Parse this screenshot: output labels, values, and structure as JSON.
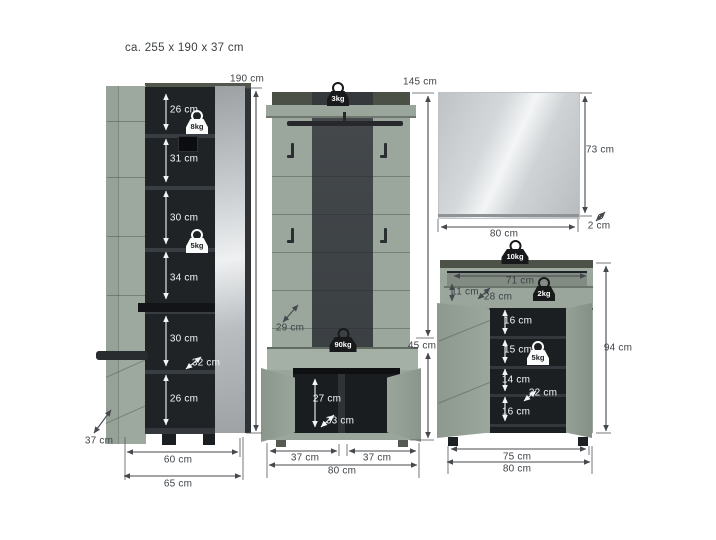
{
  "title": "ca. 255 x 190 x 37 cm",
  "colors": {
    "green": "#9BA79D",
    "interior_dark": "#202326",
    "band_gray": "#44494C",
    "mirror_light": "#E9EBEC"
  },
  "wardrobe": {
    "height": "190 cm",
    "sections": [
      "26 cm",
      "31 cm",
      "30 cm",
      "34 cm",
      "30 cm",
      "26 cm"
    ],
    "inner_depth": "32 cm",
    "depth": "37 cm",
    "inner_width": "60 cm",
    "width": "65 cm",
    "weight_top": "8kg",
    "weight_mid": "5kg"
  },
  "panel": {
    "height": "145 cm",
    "bench_height": "45 cm",
    "shelf_depth": "29 cm",
    "bench_inner_height": "27 cm",
    "bench_inner_depth": "33 cm",
    "door_left": "37 cm",
    "door_right": "37 cm",
    "width": "80 cm",
    "weight_shelf": "3kg",
    "weight_bench": "90kg"
  },
  "mirror": {
    "height": "73 cm",
    "width": "80 cm",
    "depth": "2 cm"
  },
  "cabinet": {
    "drawer_width": "71 cm",
    "drawer_height": "11 cm",
    "drawer_depth": "28 cm",
    "sections": [
      "16 cm",
      "15 cm",
      "14 cm",
      "16 cm"
    ],
    "inner_depth": "32 cm",
    "height": "94 cm",
    "inner_width": "75 cm",
    "width": "80 cm",
    "weight_top": "10kg",
    "weight_drawer": "2kg",
    "weight_shelf": "5kg"
  }
}
